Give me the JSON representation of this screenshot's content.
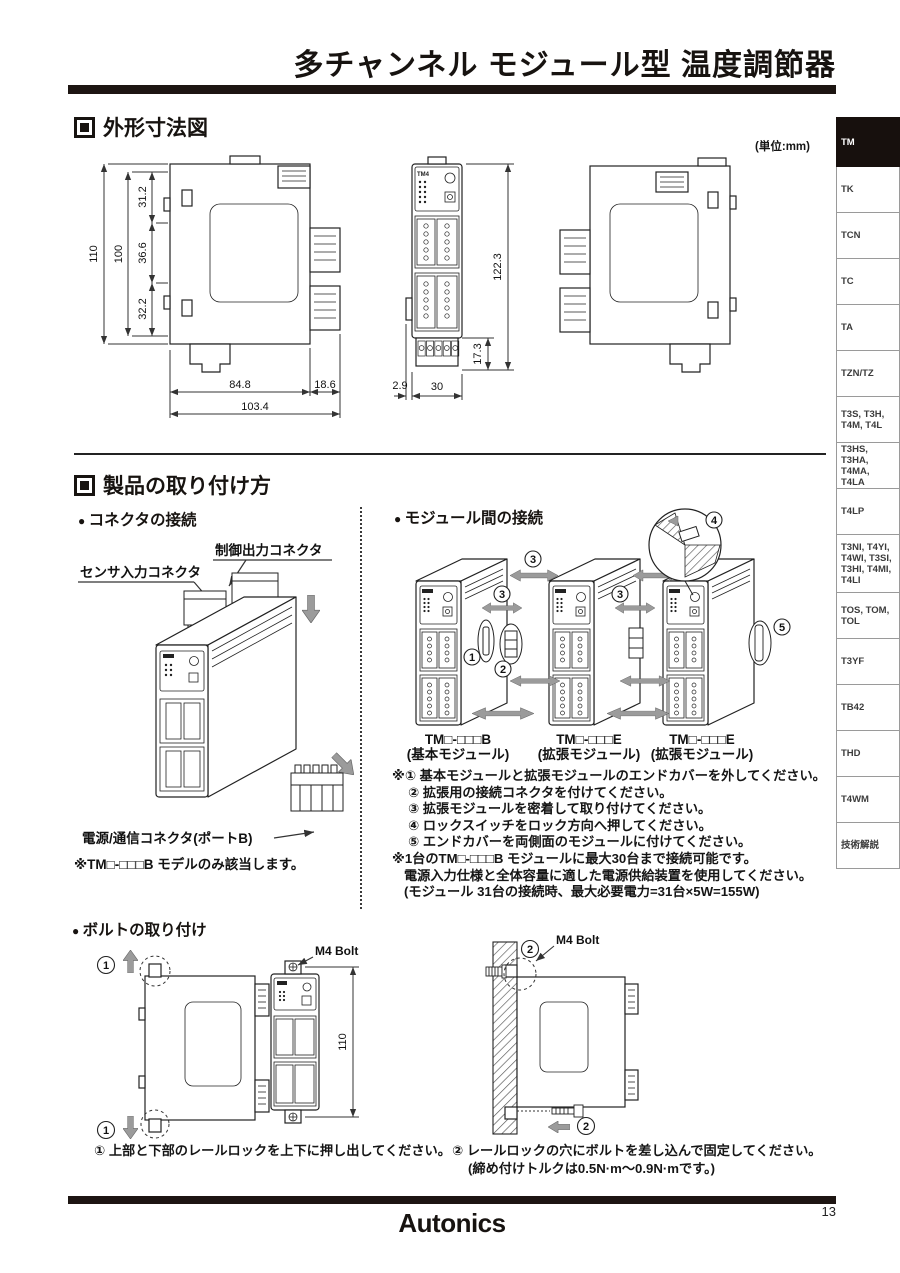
{
  "page": {
    "title": "多チャンネル モジュール型 温度調節器",
    "unit_note": "(単位:mm)",
    "brand": "Autonics",
    "page_number": "13"
  },
  "sidebar": {
    "items": [
      {
        "label": "TM",
        "active": true
      },
      {
        "label": "TK"
      },
      {
        "label": "TCN"
      },
      {
        "label": "TC"
      },
      {
        "label": "TA"
      },
      {
        "label": "TZN/TZ"
      },
      {
        "label": "T3S, T3H, T4M, T4L"
      },
      {
        "label": "T3HS, T3HA, T4MA, T4LA"
      },
      {
        "label": "T4LP"
      },
      {
        "label": "T3NI, T4YI, T4WI, T3SI, T3HI, T4MI, T4LI"
      },
      {
        "label": "TOS, TOM, TOL"
      },
      {
        "label": "T3YF"
      },
      {
        "label": "TB42"
      },
      {
        "label": "THD"
      },
      {
        "label": "T4WM"
      },
      {
        "label": "技術解説"
      }
    ]
  },
  "dim": {
    "heading": "外形寸法図",
    "module_label": "TM4",
    "labels": {
      "overall_h": "110",
      "body_h": "100",
      "seg_top": "31.2",
      "seg_mid": "36.6",
      "seg_bot": "32.2",
      "body_w": "84.8",
      "conn_w": "18.6",
      "overall_w": "103.4",
      "front_h": "122.3",
      "term_h": "17.3",
      "tab_w": "2.9",
      "front_w": "30"
    }
  },
  "mount": {
    "heading": "製品の取り付け方",
    "connector": {
      "heading": "コネクタの接続",
      "sensor_label": "センサ入力コネクタ",
      "control_label": "制御出力コネクタ",
      "power_label": "電源/通信コネクタ(ポートB)",
      "note": "※TM□-□□□B モデルのみ該当します。"
    },
    "link": {
      "heading": "モジュール間の接続",
      "digits": [
        "1",
        "2",
        "3",
        "4",
        "5"
      ],
      "modules": [
        {
          "name": "TM□-□□□B",
          "type": "(基本モジュール)"
        },
        {
          "name": "TM□-□□□E",
          "type": "(拡張モジュール)"
        },
        {
          "name": "TM□-□□□E",
          "type": "(拡張モジュール)"
        }
      ],
      "steps": [
        "※① 基本モジュールと拡張モジュールのエンドカバーを外してください。",
        "② 拡張用の接続コネクタを付けてください。",
        "③ 拡張モジュールを密着して取り付けてください。",
        "④ ロックスイッチをロック方向へ押してください。",
        "⑤ エンドカバーを両側面のモジュールに付けてください。",
        "※1台のTM□-□□□B モジュールに最大30台まで接続可能です。",
        "電源入力仕様と全体容量に適した電源供給装置を使用してください。",
        "(モジュール 31台の接続時、最大必要電力=31台×5W=155W)"
      ]
    },
    "bolt": {
      "heading": "ボルトの取り付け",
      "m4_label": "M4 Bolt",
      "height": "110",
      "digits": [
        "1",
        "2"
      ],
      "captions": [
        "① 上部と下部のレールロックを上下に押し出してください。",
        "② レールロックの穴にボルトを差し込んで固定してください。",
        "(締め付けトルクは0.5N·m〜0.9N·mです。)"
      ]
    }
  }
}
